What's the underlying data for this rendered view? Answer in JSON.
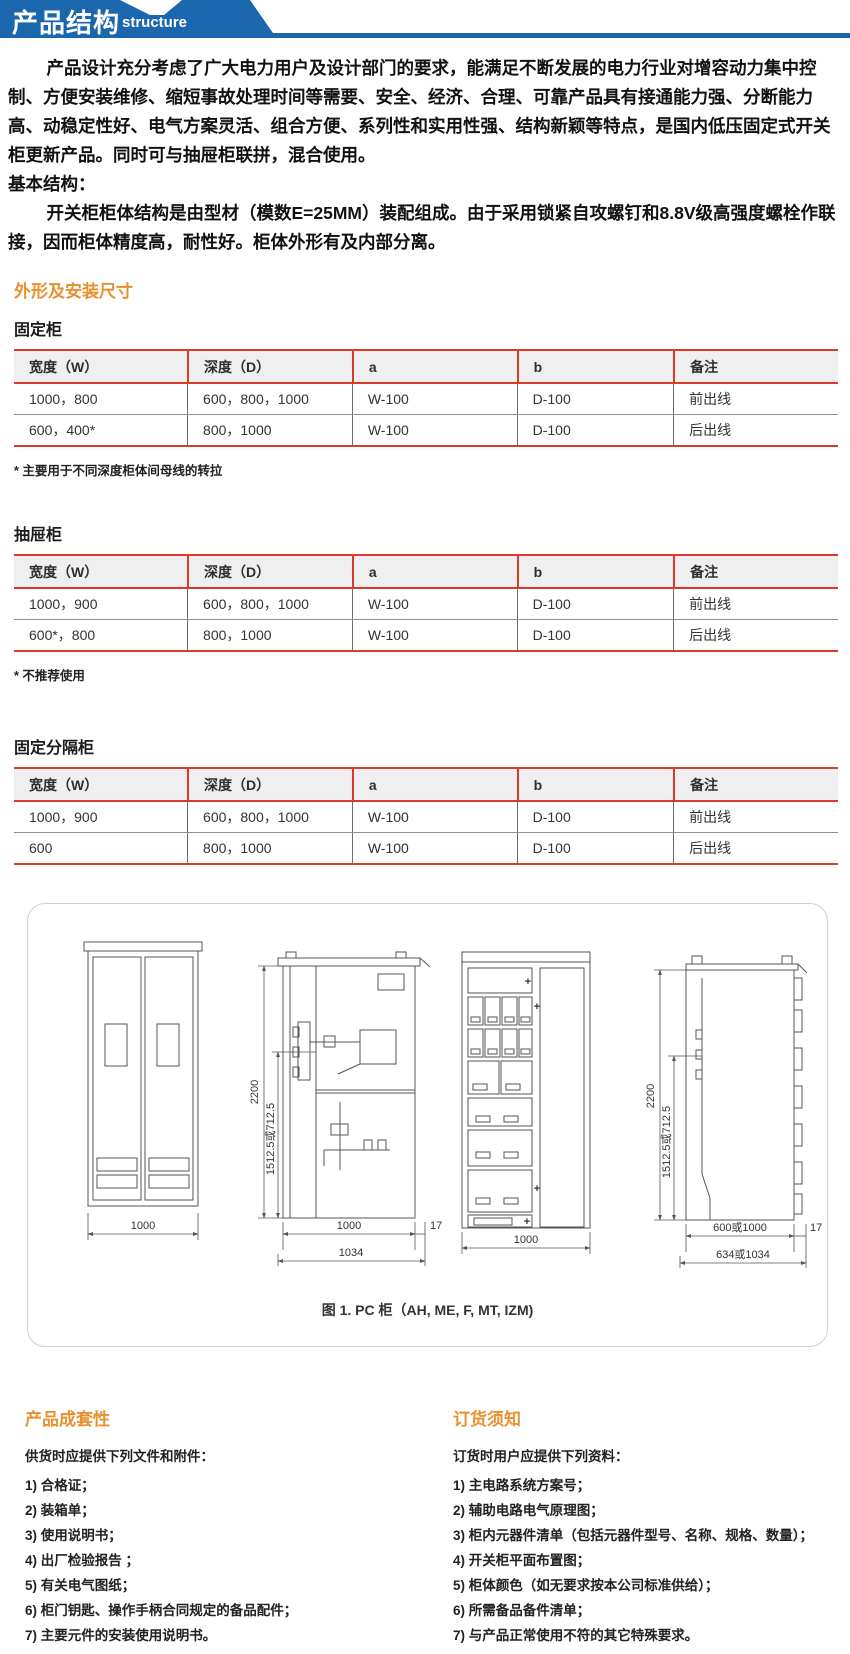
{
  "header": {
    "title": "产品结构",
    "subtitle": "structure"
  },
  "intro": {
    "p1": "产品设计充分考虑了广大电力用户及设计部门的要求，能满足不断发展的电力行业对增容动力集中控制、方便安装维修、缩短事故处理时间等需要、安全、经济、合理、可靠产品具有接通能力强、分断能力高、动稳定性好、电气方案灵活、组合方便、系列性和实用性强、结构新颖等特点，是国内低压固定式开关柜更新产品。同时可与抽屉柜联拼，混合使用。",
    "p2": "基本结构：",
    "p3": "开关柜柜体结构是由型材（模数E=25MM）装配组成。由于采用锁紧自攻螺钉和8.8V级高强度螺栓作联接，因而柜体精度高，耐性好。柜体外形有及内部分离。"
  },
  "section_title": "外形及安装尺寸",
  "tables": [
    {
      "title": "固定柜",
      "headers": [
        "宽度（W）",
        "深度（D）",
        "a",
        "b",
        "备注"
      ],
      "rows": [
        [
          "1000，800",
          "600，800，1000",
          "W-100",
          "D-100",
          "前出线"
        ],
        [
          "600，400*",
          "800，1000",
          "W-100",
          "D-100",
          "后出线"
        ]
      ],
      "footnote": "* 主要用于不同深度柜体间母线的转拉"
    },
    {
      "title": "抽屉柜",
      "headers": [
        "宽度（W）",
        "深度（D）",
        "a",
        "b",
        "备注"
      ],
      "rows": [
        [
          "1000，900",
          "600，800，1000",
          "W-100",
          "D-100",
          "前出线"
        ],
        [
          "600*，800",
          "800，1000",
          "W-100",
          "D-100",
          "后出线"
        ]
      ],
      "footnote": "* 不推荐使用"
    },
    {
      "title": "固定分隔柜",
      "headers": [
        "宽度（W）",
        "深度（D）",
        "a",
        "b",
        "备注"
      ],
      "rows": [
        [
          "1000，900",
          "600，800，1000",
          "W-100",
          "D-100",
          "前出线"
        ],
        [
          "600",
          "800，1000",
          "W-100",
          "D-100",
          "后出线"
        ]
      ],
      "footnote": ""
    }
  ],
  "figure": {
    "caption": "图 1. PC 柜（AH, ME, F, MT, IZM)",
    "plus": "+",
    "d1": {
      "width": "1000"
    },
    "d2": {
      "height": "2200",
      "inner": "1512.5或712.5",
      "w1": "1000",
      "off": "17",
      "w2": "1034"
    },
    "d3": {
      "width": "1000"
    },
    "d4": {
      "height": "2200",
      "inner": "1512.5或712.5",
      "w1": "600或1000",
      "off": "17",
      "w2": "634或1034"
    }
  },
  "bottom_left": {
    "title": "产品成套性",
    "intro": "供货时应提供下列文件和附件：",
    "items": [
      "1) 合格证；",
      "2) 装箱单；",
      "3) 使用说明书；",
      "4) 出厂检验报告 ；",
      "5) 有关电气图纸；",
      "6) 柜门钥匙、操作手柄合同规定的备品配件；",
      "7) 主要元件的安装使用说明书。"
    ]
  },
  "bottom_right": {
    "title": "订货须知",
    "intro": "订货时用户应提供下列资料：",
    "items": [
      "1) 主电路系统方案号；",
      "2)  辅助电路电气原理图；",
      "3) 柜内元器件清单（包括元器件型号、名称、规格、数量）；",
      "4) 开关柜平面布置图；",
      "5) 柜体颜色（如无要求按本公司标准供给）；",
      "6) 所需备品备件清单；",
      "7) 与产品正常使用不符的其它特殊要求。"
    ]
  },
  "colors": {
    "banner_blue": "#1a67ad",
    "accent_orange": "#e8912c",
    "table_red": "#dc3a28"
  }
}
